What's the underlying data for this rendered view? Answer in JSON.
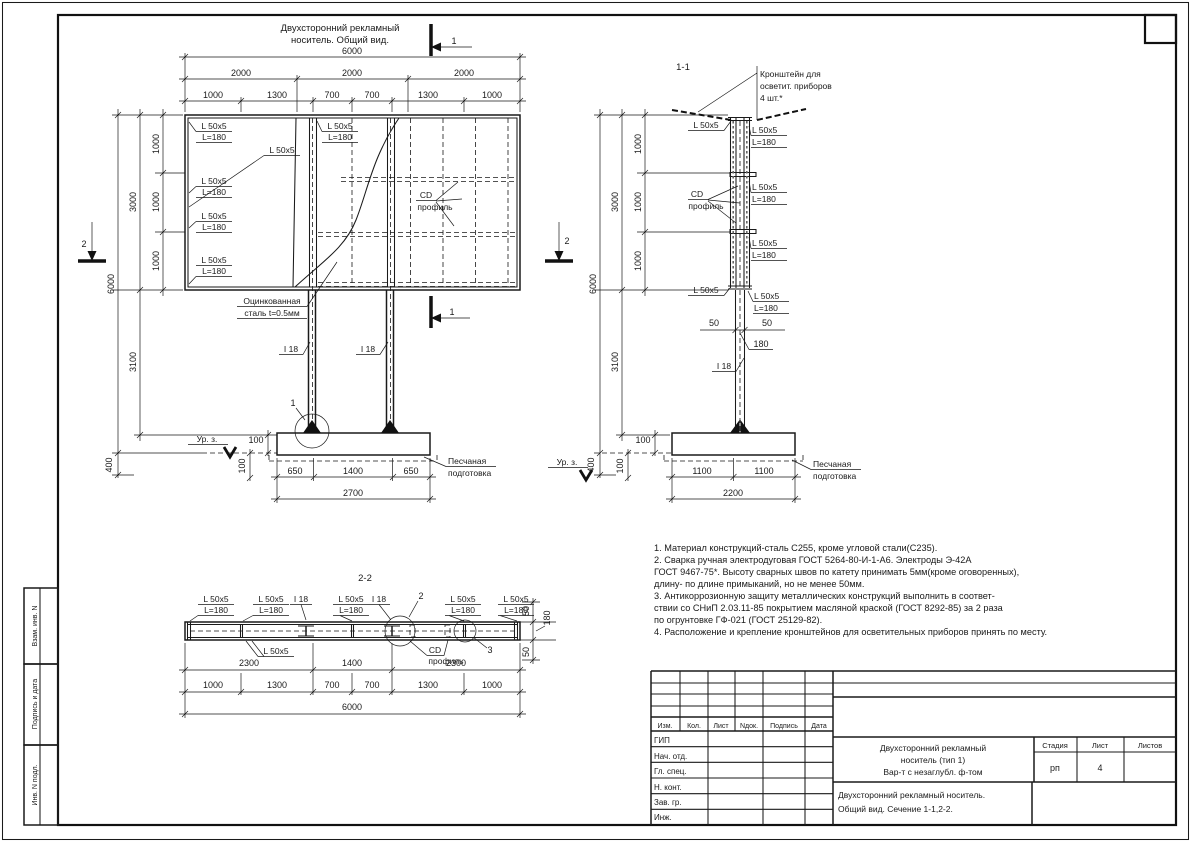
{
  "front_title": {
    "line1": "Двухсторонний рекламный",
    "line2": "носитель. Общий вид."
  },
  "marks": {
    "sec1": "1",
    "sec2": "2",
    "det1": "1",
    "det2": "2",
    "det3": "3",
    "view11": "1-1",
    "view22": "2-2"
  },
  "labels": {
    "angle": "L 50x5",
    "length": "L=180",
    "ibeam": "I 18",
    "cd1": "CD",
    "cd2": "профиль",
    "zinc1": "Оцинкованная",
    "zinc2": "сталь t=0.5мм",
    "ground": "Ур. з.",
    "sand1": "Песчаная",
    "sand2": "подготовка",
    "bracket1": "Кронштейн для",
    "bracket2": "осветит. приборов",
    "bracket3": "4 шт.*"
  },
  "dims": {
    "d50": "50",
    "d100": "100",
    "d180": "180",
    "d400": "400",
    "d650": "650",
    "d700": "700",
    "d1000": "1000",
    "d1100": "1100",
    "d1300": "1300",
    "d1400": "1400",
    "d2000": "2000",
    "d2200": "2200",
    "d2300": "2300",
    "d2700": "2700",
    "d3000": "3000",
    "d3100": "3100",
    "d6000": "6000"
  },
  "notes": {
    "lines": [
      "1. Материал конструкций-сталь С255, кроме угловой стали(С235).",
      "2. Сварка ручная электродуговая ГОСТ 5264-80-И-1-А6. Электроды Э-42А",
      "ГОСТ 9467-75*. Высоту сварных швов по катету принимать 5мм(кроме оговоренных),",
      "длину- по длине примыканий, но не менее 50мм.",
      "3. Антикоррозионную защиту металлических конструкций выполнить в соответ-",
      "ствии со СНиП 2.03.11-85 покрытием масляной краской (ГОСТ 8292-85) за 2 раза",
      "по огрунтовке ГФ-021 (ГОСТ 25129-82).",
      "4. Расположение и крепление кронштейнов для осветительных приборов принять по месту."
    ]
  },
  "sidebar": {
    "box1": "Взам. инв. N",
    "box2": "Подпись и дата",
    "box3": "Инв. N подл."
  },
  "titleblock": {
    "header": {
      "izm": "Изм.",
      "kol": "Кол.",
      "list": "Лист",
      "ndok": "Nдок.",
      "podpis": "Подпись",
      "data": "Дата"
    },
    "roles": {
      "r1": "ГИП",
      "r2": "Нач. отд.",
      "r3": "Гл. спец.",
      "r4": "Н. конт.",
      "r5": "Зав. гр.",
      "r6": "Инж."
    },
    "doc": {
      "t1": "Двухсторонний рекламный",
      "t2": "носитель (тип 1)",
      "t3": "Вар-т с незаглубл. ф-том"
    },
    "stage_label": "Стадия",
    "sheet_label": "Лист",
    "sheets_label": "Листов",
    "stage": "рп",
    "sheet": "4",
    "subtitle1": "Двухсторонний рекламный носитель.",
    "subtitle2": "Общий вид.  Сечение 1-1,2-2."
  }
}
